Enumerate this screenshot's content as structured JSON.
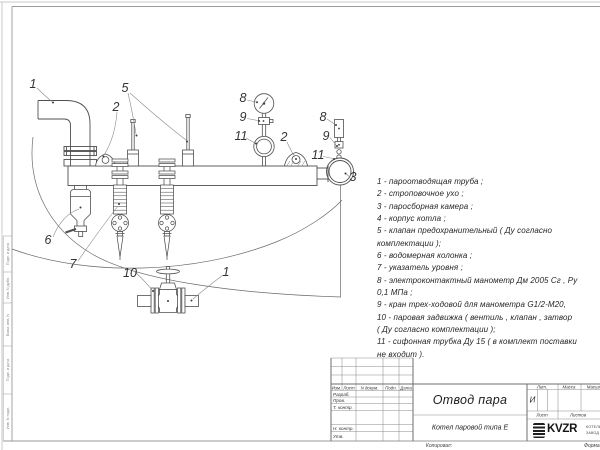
{
  "sheet": {
    "footer_copied": "Копировал:",
    "footer_format": "Формат"
  },
  "parts_list": {
    "lines": [
      "1 -  пароотводящая труба ;",
      "2 -  строповочное ухо ;",
      "3 -  паросборная камера ;",
      "4 -  корпус котла ;",
      "5 -  клапан предохранительный  ( Ду согласно",
      "комплектации );",
      "6 -  водомерная колонка ;",
      "7 - указатель уровня ;",
      "8 - электроконтактный манометр  Дм 2005 Сг ,  Ру",
      "0,1 МПа ;",
      "9 -  кран трех-ходовой для манометра  G1/2-М20,",
      "10 -  паровая задвижка  ( вентиль ,  клапан ,  затвор",
      "( Ду согласно комплектации );",
      "11 -  сифонная трубка  Ду 15  ( в комплект поставки",
      "не входит )."
    ]
  },
  "callouts": [
    {
      "n": "1",
      "x": 33,
      "y": 84
    },
    {
      "n": "2",
      "x": 116,
      "y": 107
    },
    {
      "n": "5",
      "x": 125,
      "y": 88
    },
    {
      "n": "8",
      "x": 243,
      "y": 98
    },
    {
      "n": "9",
      "x": 243,
      "y": 117
    },
    {
      "n": "11",
      "x": 241,
      "y": 136
    },
    {
      "n": "2",
      "x": 284,
      "y": 137
    },
    {
      "n": "8",
      "x": 323,
      "y": 117
    },
    {
      "n": "9",
      "x": 326,
      "y": 136
    },
    {
      "n": "11",
      "x": 318,
      "y": 155
    },
    {
      "n": "3",
      "x": 353,
      "y": 177
    },
    {
      "n": "6",
      "x": 48,
      "y": 240
    },
    {
      "n": "7",
      "x": 73,
      "y": 264
    },
    {
      "n": "10",
      "x": 130,
      "y": 273
    },
    {
      "n": "1",
      "x": 226,
      "y": 272
    }
  ],
  "title_block": {
    "change_header": [
      "Изм.",
      "Лист",
      "N докум.",
      "Подп.",
      "Дата"
    ],
    "sig_rows": [
      "Разраб.",
      "Пров.",
      "Т. контр.",
      "Н. контр.",
      "Утв."
    ],
    "title": "Отвод пара",
    "subtitle": "Котел паровой типа Е",
    "lit_label": "Лит.",
    "lit_value": "И",
    "mass_label": "Масса",
    "scale_label": "Масштаб",
    "sheet_label": "Лист",
    "sheets_label": "Листов",
    "logo_text": "KVZR",
    "logo_caption_line1": "КОТЕЛЬНЫЙ",
    "logo_caption_line2": "ЗАВОД Р"
  },
  "margin_stamp": {
    "labels": [
      "Подп. и дата",
      "Инв. N дубл.",
      "Взам. инв. N",
      "Подп. и дата",
      "Инв. N подл."
    ]
  }
}
